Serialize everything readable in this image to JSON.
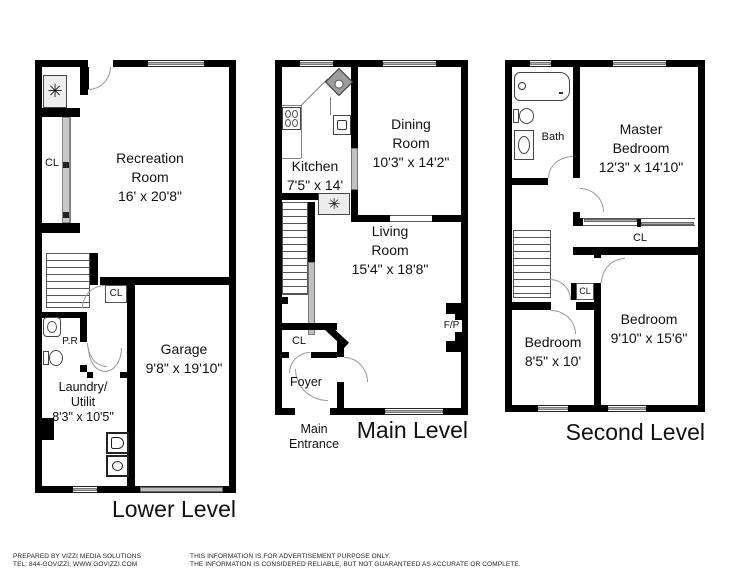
{
  "symbols": {
    "appliance": "✳"
  },
  "floors": {
    "lower": {
      "title": "Lower Level",
      "rooms": {
        "recreation": {
          "name": "Recreation Room",
          "dims": "16' x 20'8\""
        },
        "garage": {
          "name": "Garage",
          "dims": "9'8\" x 19'10\""
        },
        "laundry": {
          "name": "Laundry/ Utilit",
          "dims": "8'3\" x 10'5\""
        },
        "closet_left": {
          "label": "CL"
        },
        "closet_mid": {
          "label": "CL"
        },
        "powder": {
          "label": "P.R"
        }
      }
    },
    "main": {
      "title": "Main Level",
      "rooms": {
        "kitchen": {
          "name": "Kitchen",
          "dims": "7'5\" x 14'"
        },
        "dining": {
          "name": "Dining Room",
          "dims": "10'3\" x 14'2\""
        },
        "living": {
          "name": "Living Room",
          "dims": "15'4\" x 18'8\""
        },
        "closet": {
          "label": "CL"
        },
        "foyer": {
          "label": "Foyer"
        },
        "fireplace": {
          "label": "F/P"
        },
        "entrance": {
          "label": "Main Entrance"
        }
      }
    },
    "second": {
      "title": "Second Level",
      "rooms": {
        "bath": {
          "label": "Bath"
        },
        "master": {
          "name": "Master Bedroom",
          "dims": "12'3\" x 14'10\""
        },
        "closet_long": {
          "label": "CL"
        },
        "closet_small": {
          "label": "CL"
        },
        "bedroom_small": {
          "name": "Bedroom",
          "dims": "8'5\" x 10'"
        },
        "bedroom_mid": {
          "name": "Bedroom",
          "dims": "9'10\" x 15'6\""
        }
      }
    }
  },
  "footer": {
    "left_line1": "PREPARED BY VIZZI MEDIA SOLUTIONS",
    "left_line2": "TEL: 844-GOVIZZI, WWW.GOVIZZI.COM",
    "right_line1": "THIS INFORMATION IS FOR ADVERTISEMENT PURPOSE ONLY.",
    "right_line2": "THE INFORMATION IS CONSIDERED RELIABLE, BUT NOT GUARANTEED AS ACCURATE OR COMPLETE."
  }
}
